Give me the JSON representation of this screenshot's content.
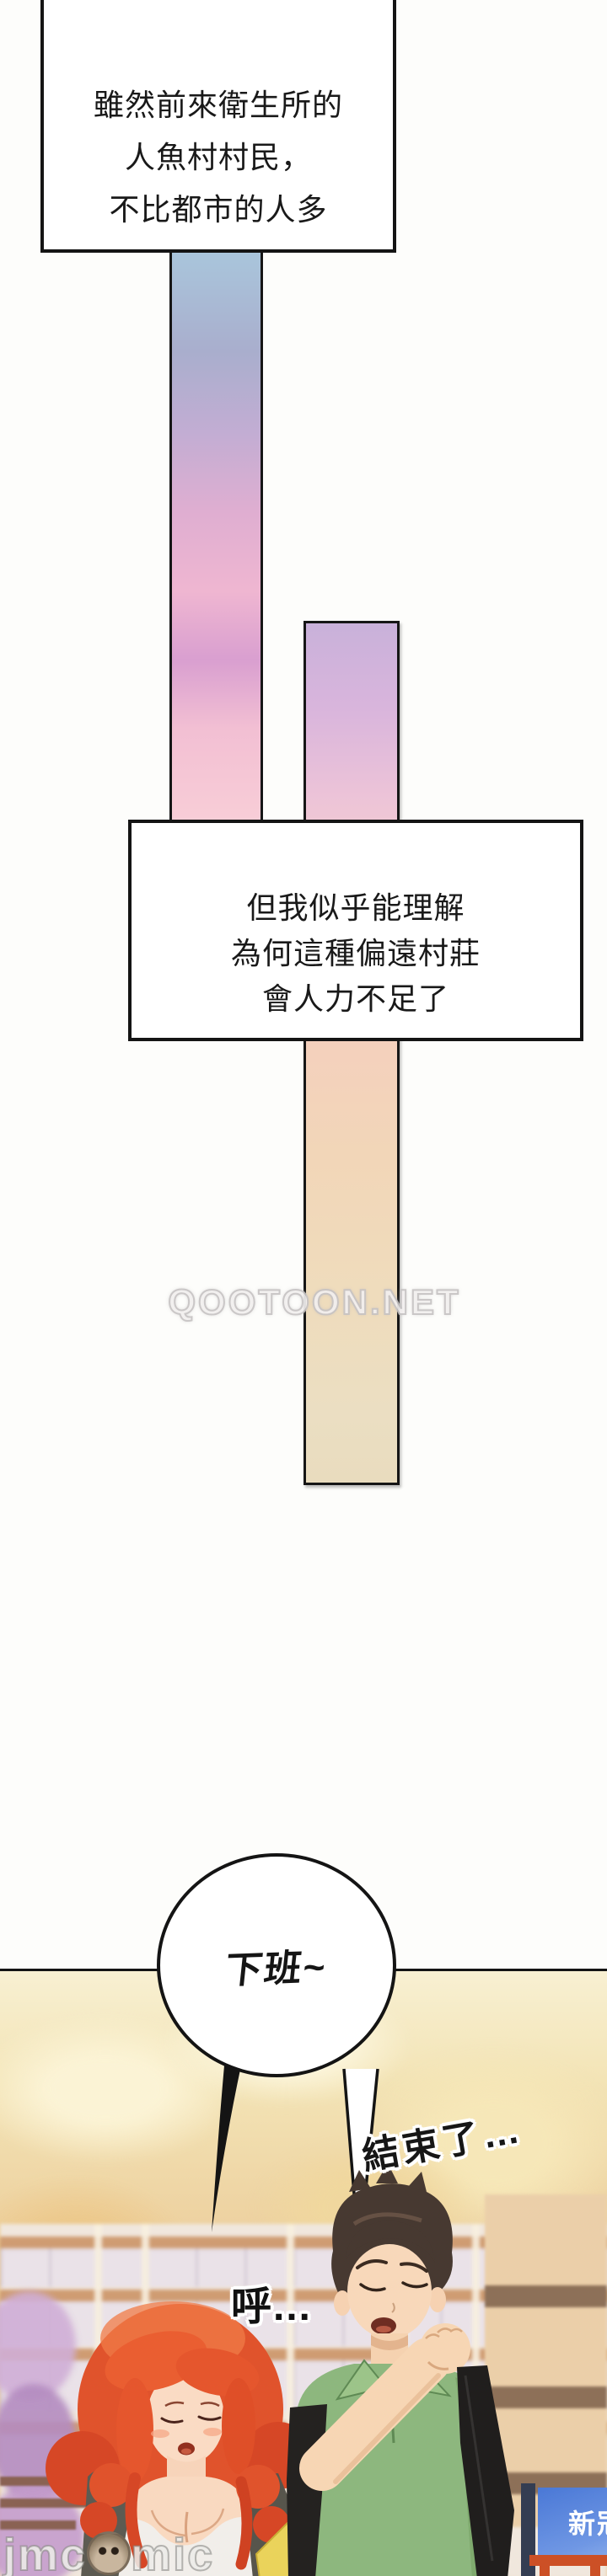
{
  "page": {
    "type": "webtoon-comic-page",
    "background": "#fdfdfb",
    "line_color": "#141414"
  },
  "narration_box_1": {
    "lines": [
      "雖然前來衛生所的",
      "人魚村村民，",
      "不比都市的人多"
    ]
  },
  "narration_box_2": {
    "lines": [
      "但我似乎能理解",
      "為何這種偏遠村莊",
      "會人力不足了"
    ]
  },
  "speech_bubble": {
    "text": "下班~"
  },
  "sfx": [
    {
      "text": "結束了…"
    },
    {
      "text": "呼…"
    }
  ],
  "scene": {
    "sign_text": "新冠"
  },
  "watermarks": {
    "site": "QOOTOON.NET",
    "brand_prefix": "jmc",
    "brand_suffix": "mic",
    "brand_icon": "monkey-face-o"
  },
  "colors": {
    "strip1_top": "#a9c6dc",
    "strip1_bottom": "#f8cdd7",
    "strip2_top": "#c9b1da",
    "strip2_bottom": "#e9dcbe",
    "sky_top": "#f8f0d2",
    "sky_bottom": "#eccb9b",
    "railing": "#cf9c72",
    "woman_hair": "#e0532c",
    "man_shirt": "#8db77e",
    "sign_blue": "#4a78d6",
    "frame_orange": "#cc5026"
  }
}
